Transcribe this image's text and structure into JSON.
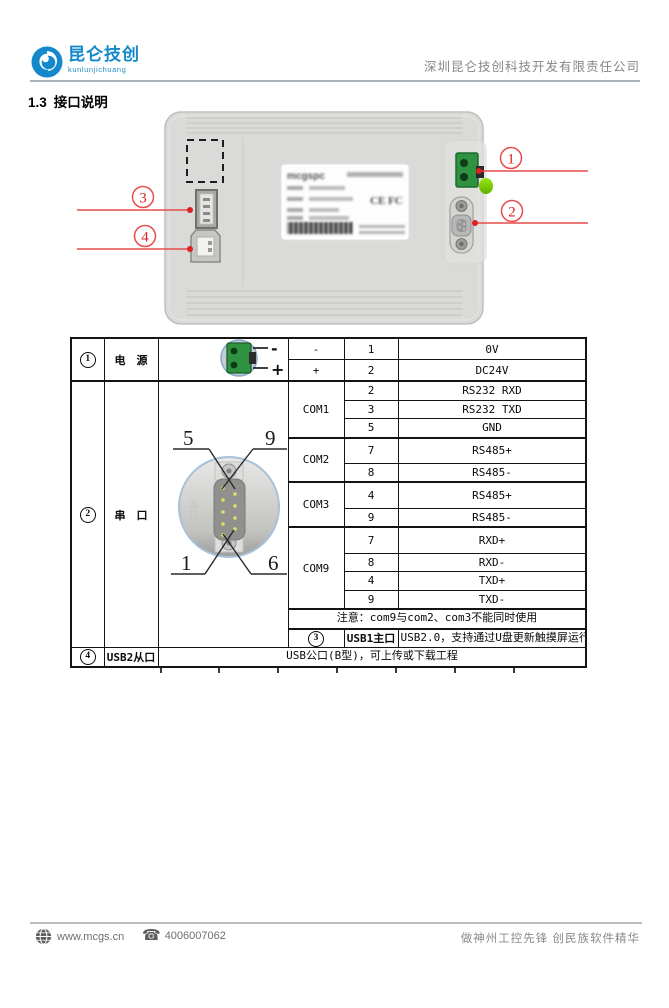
{
  "header": {
    "logo_title": "昆仑技创",
    "logo_subtitle": "kunlunjichuang",
    "company_name": "深圳昆仑技创科技开发有限责任公司"
  },
  "section": {
    "number": "1.3",
    "title": "接口说明"
  },
  "figure": {
    "callouts": {
      "c1": "1",
      "c2": "2",
      "c3": "3",
      "c4": "4"
    },
    "device_label": {
      "logo": "mcgspc",
      "marks": "CE FC"
    },
    "db9_pin_labels": {
      "top_left": "5",
      "top_right": "9",
      "bottom_left": "1",
      "bottom_right": "6"
    }
  },
  "table": {
    "power": {
      "num": "1",
      "name": "电　源",
      "minus_label": "-",
      "plus_label": "+",
      "rows": [
        {
          "sym": "-",
          "pin": "1",
          "desc": "0V"
        },
        {
          "sym": "+",
          "pin": "2",
          "desc": "DC24V"
        }
      ]
    },
    "serial": {
      "num": "2",
      "name": "串　口",
      "groups": [
        {
          "name": "COM1",
          "pins": [
            {
              "pin": "2",
              "desc": "RS232 RXD"
            },
            {
              "pin": "3",
              "desc": "RS232 TXD"
            },
            {
              "pin": "5",
              "desc": "GND"
            }
          ]
        },
        {
          "name": "COM2",
          "pins": [
            {
              "pin": "7",
              "desc": "RS485+"
            },
            {
              "pin": "8",
              "desc": "RS485-"
            }
          ]
        },
        {
          "name": "COM3",
          "pins": [
            {
              "pin": "4",
              "desc": "RS485+"
            },
            {
              "pin": "9",
              "desc": "RS485-"
            }
          ]
        },
        {
          "name": "COM9",
          "pins": [
            {
              "pin": "7",
              "desc": "RXD+"
            },
            {
              "pin": "8",
              "desc": "RXD-"
            },
            {
              "pin": "4",
              "desc": "TXD+"
            },
            {
              "pin": "9",
              "desc": "TXD-"
            }
          ]
        }
      ],
      "note": "注意：com9与com2、com3不能同时使用"
    },
    "usb1": {
      "num": "3",
      "name": "USB1主口",
      "desc": "USB2.0，支持通过U盘更新触摸屏运行环境、工程、系统，以及数据导入和导出等功能"
    },
    "usb2": {
      "num": "4",
      "name": "USB2从口",
      "desc": "USB公口(B型)，可上传或下载工程"
    }
  },
  "footer": {
    "website": "www.mcgs.cn",
    "phone": "4006007062",
    "slogan": "做神州工控先锋 创民族软件精华"
  },
  "colors": {
    "brand_blue": "#1488cc",
    "callout_red": "#e84b4b",
    "connector_green": "#2f9240",
    "device_gray": "#dadad8"
  }
}
